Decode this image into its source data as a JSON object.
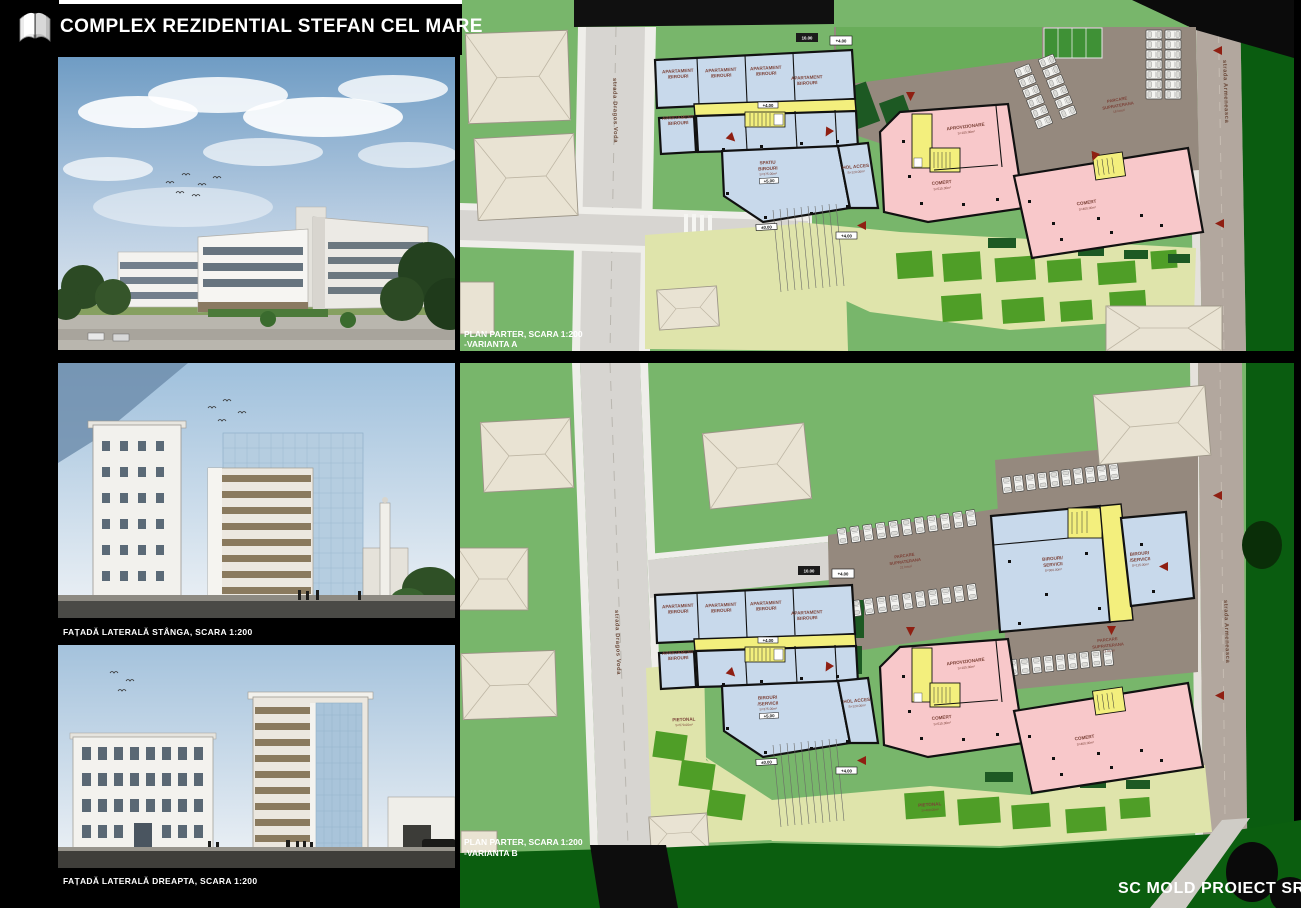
{
  "header": {
    "title": "COMPLEX REZIDENTIAL STEFAN CEL MARE"
  },
  "footer": {
    "company": "SC MOLD PROIECT SRL"
  },
  "left_panels": {
    "elevation_left_caption": "FAȚADĂ LATERALĂ STÂNGA, SCARA 1:200",
    "elevation_right_caption": "FAȚADĂ LATERALĂ  DREAPTA, SCARA 1:200"
  },
  "streets": {
    "left": "strada Dragos Voda",
    "right": "strada Armeneasca"
  },
  "room_labels": {
    "apartament_l1": "APARTAMENT",
    "apartament_l2": "/BIROURI",
    "spatiu_l1": "SPATIU",
    "spatiu_l2": "BIROURI",
    "birouri_l1": "BIROURI",
    "birouri_l2": "/SERVICII",
    "birouri_large_l1": "BIROURI/",
    "birouri_large_l2": "SERVICII",
    "hol": "HOL ACCES",
    "aprovizionare": "APROVIZIONARE",
    "comert": "COMERT",
    "parcare_l1": "PARCARE",
    "parcare_l2": "SUPRATERANA",
    "pietonal": "PIETONAL"
  },
  "areas": {
    "spatiu": "S=375.00m²",
    "birouri_center": "S=375.00m²",
    "hol": "S=120.00m²",
    "aprovizionare": "S=105.00m²",
    "comert1": "S=515.00m²",
    "comert2": "S=460.00m²",
    "birouri_large": "S=300.00m²",
    "birouri_small": "S=115.00m²",
    "pietonal_left": "S=570.00m²",
    "pietonal_bottom": "S=400.00m²"
  },
  "levels": {
    "corridor": "+4.00",
    "office": "+5.00",
    "ground": "±0.00",
    "plaza": "+4.00",
    "dim": "10.00"
  },
  "parking": {
    "plan_a": "18 locuri",
    "plan_b_mid": "21 locuri",
    "plan_b_right": "23 locuri"
  },
  "plan_a": {
    "caption_line1": "PLAN PARTER, SCARA 1:200",
    "caption_line2": "-VARIANTA A"
  },
  "plan_b": {
    "caption_line1": "PLAN PARTER, SCARA 1:200",
    "caption_line2": "-VARIANTA B"
  },
  "colors": {
    "site_green": "#78b66b",
    "dark_green": "#0a5c10",
    "plaza": "#dfe4ab",
    "room_blue": "#c8d9eb",
    "room_pink": "#f8c8ca",
    "core_yellow": "#f3ef7d",
    "road_gray": "#d7d5d1",
    "parking_taupe": "#95897e",
    "street_taupe": "#b2a79e",
    "house_beige": "#e9e3d3",
    "label_brown": "#7c4238",
    "arrow_red": "#8f1f12",
    "wall_black": "#111111"
  }
}
